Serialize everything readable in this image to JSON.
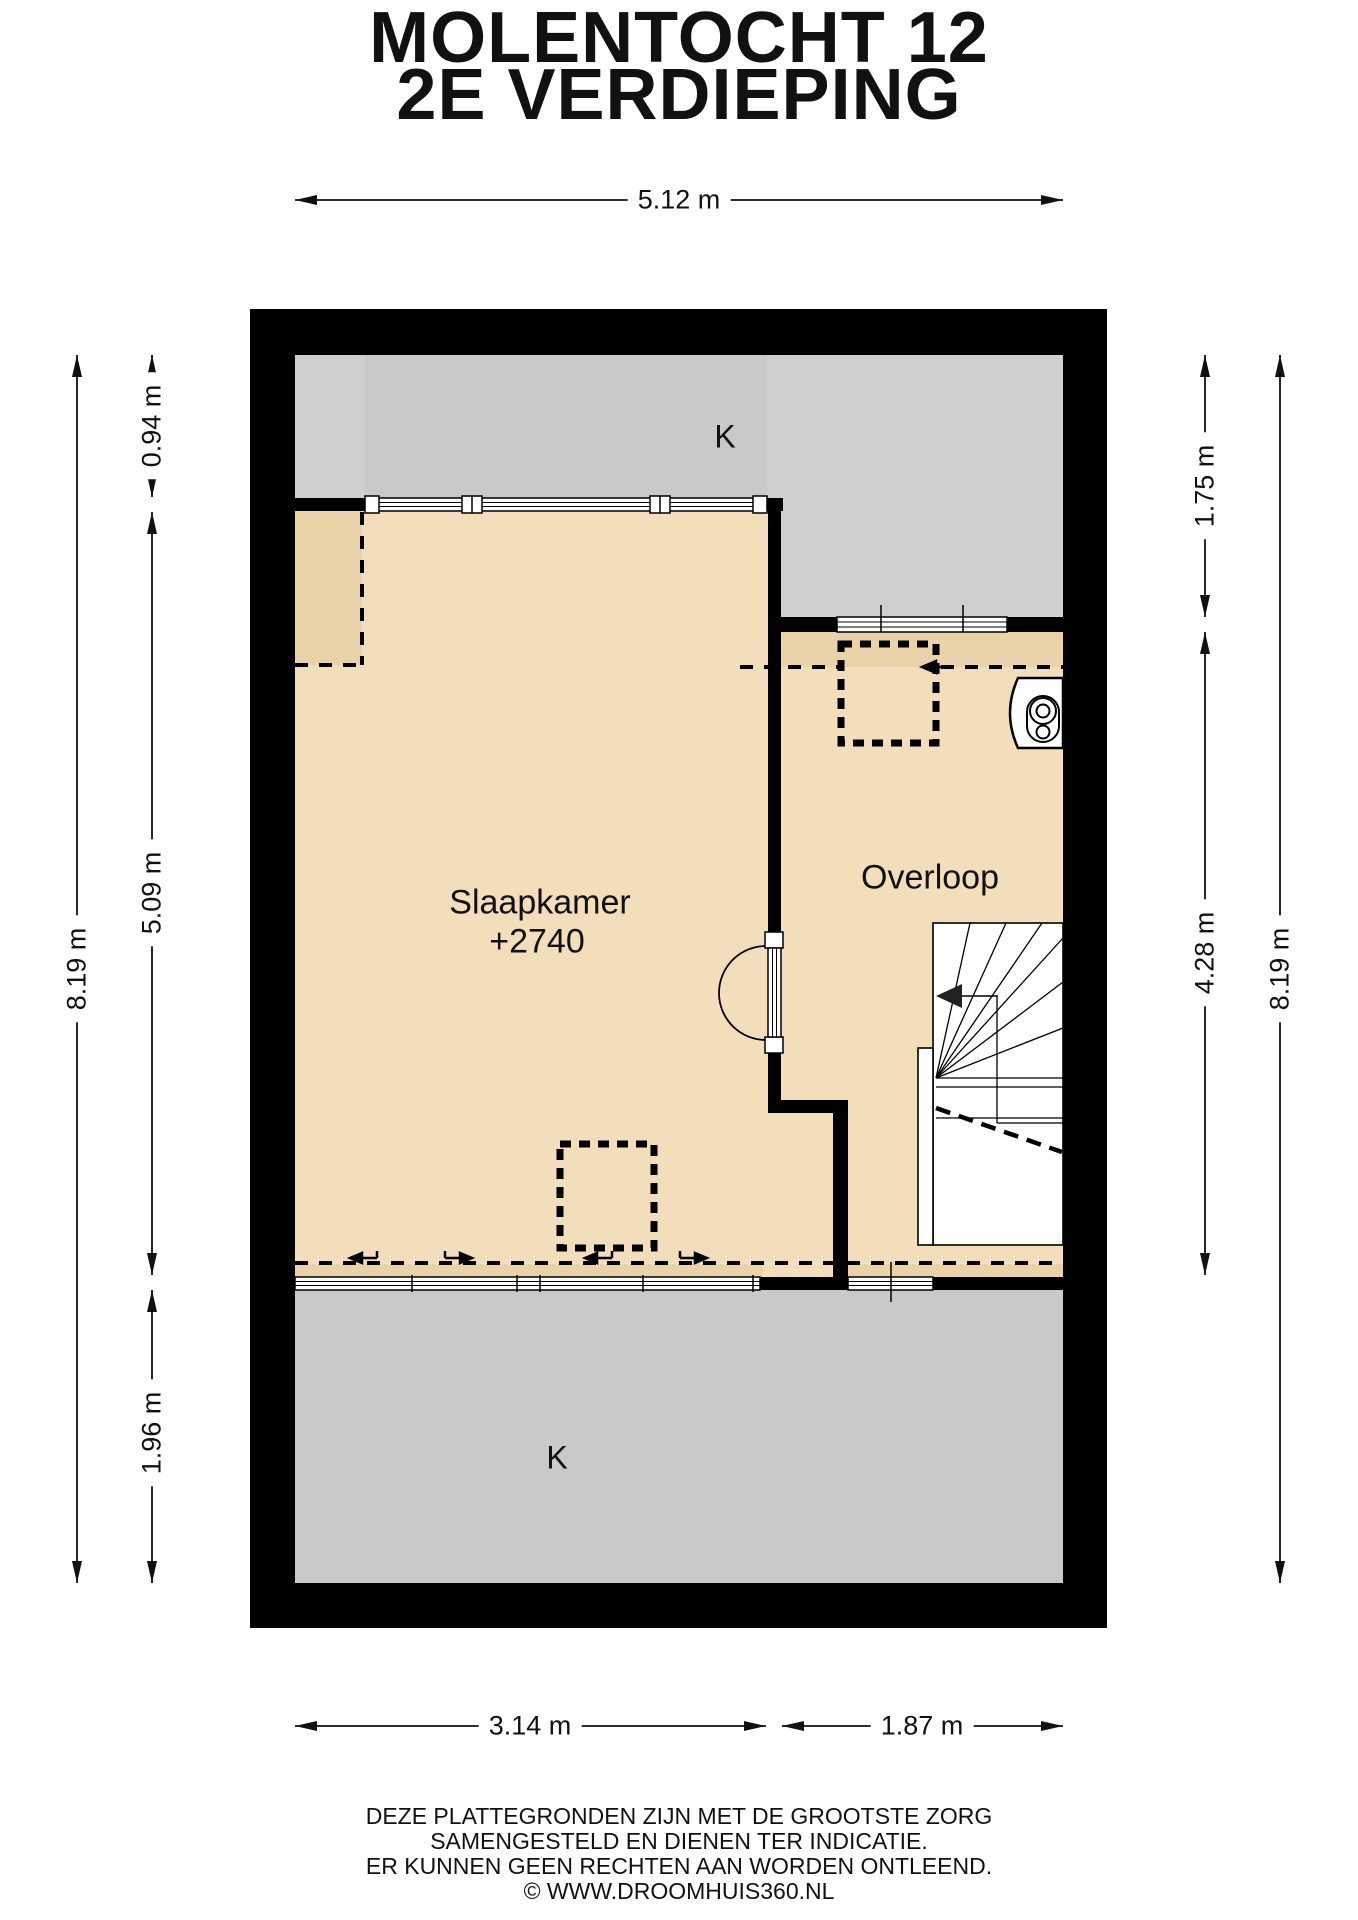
{
  "title": {
    "line1": "MOLENTOCHT 12",
    "line2": "2E VERDIEPING"
  },
  "dimensions": {
    "top": "5.12 m",
    "left_outer": "8.19 m",
    "left_segments": [
      "0.94 m",
      "5.09 m",
      "1.96 m"
    ],
    "right_segments": [
      "1.75 m",
      "4.28 m"
    ],
    "right_outer": "8.19 m",
    "bottom_segments": [
      "3.14 m",
      "1.87 m"
    ]
  },
  "rooms": {
    "slaapkamer": {
      "label": "Slaapkamer",
      "elevation": "+2740"
    },
    "overloop": {
      "label": "Overloop"
    },
    "attic_top": {
      "label": "K"
    },
    "attic_bottom": {
      "label": "K"
    }
  },
  "icons": [
    "velux-roof-window-icon",
    "boiler-unit-icon",
    "stairs-icon",
    "door-swing-icon"
  ],
  "footer": {
    "lines": [
      "DEZE PLATTEGRONDEN ZIJN MET DE GROOTSTE ZORG",
      "SAMENGESTELD EN DIENEN TER INDICATIE.",
      "ER KUNNEN GEEN RECHTEN AAN WORDEN ONTLEEND.",
      "© WWW.DROOMHUIS360.NL"
    ]
  },
  "colors": {
    "floor": "#f2debb",
    "floor_shaded": "#ebd3a9",
    "attic": "#c9c9c9",
    "attic_light": "#cfcfcf",
    "wall": "#000000",
    "line": "#111111",
    "background": "#ffffff"
  }
}
